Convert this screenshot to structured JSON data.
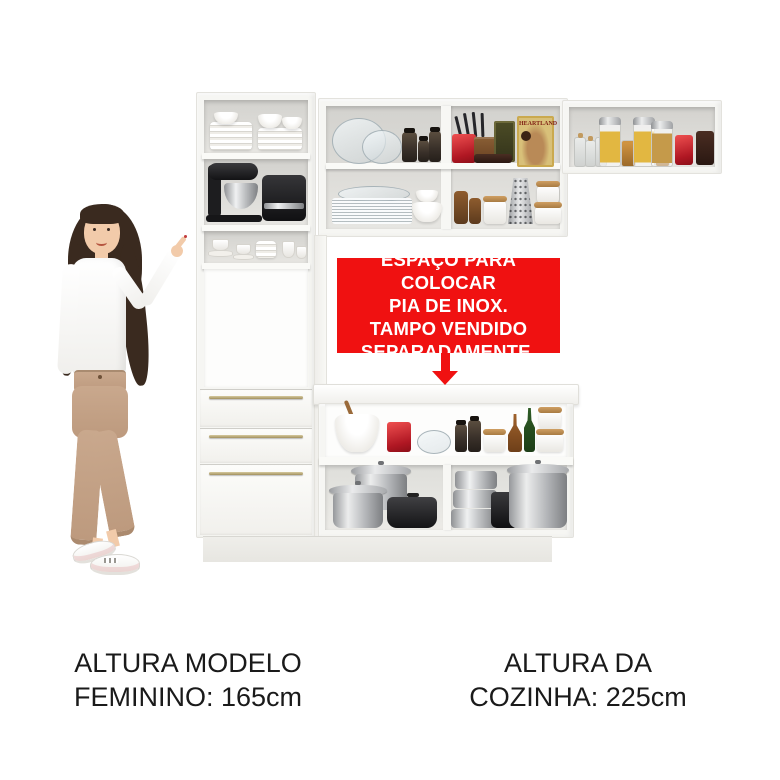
{
  "meta": {
    "image_type": "kitchen cabinet product photo with female model"
  },
  "banner": {
    "lines": [
      "ESPAÇO PARA COLOCAR",
      "PIA DE INOX.",
      "TAMPO VENDIDO",
      "SEPARADAMENTE."
    ],
    "bg_color": "#f01111",
    "text_color": "#ffffff",
    "arrow_icon": "arrow-down-icon"
  },
  "captions": {
    "model_height_line1": "ALTURA MODELO",
    "model_height_line2": "FEMININO: 165cm",
    "kitchen_height_line1": "ALTURA DA",
    "kitchen_height_line2": "COZINHA: 225cm",
    "text_color": "#1a1a1a"
  },
  "packages": {
    "heartland": "HEARTLAND"
  },
  "colors": {
    "banner_red": "#f01111",
    "cabinet_white": "#f6f6f3",
    "interior_gray": "#d7d6d2",
    "handle_gold": "#b3a674",
    "text_black": "#1a1a1a"
  },
  "scene_objects": {
    "left_figure": "woman model pointing at kitchen",
    "tall_cabinet": [
      "white plates and bowls",
      "black stand mixer with steel bowl",
      "black coffee machine",
      "white cups and saucers",
      "open microwave nook",
      "three drawers with gold handles"
    ],
    "upper_middle_cabinet": [
      "glass bowls",
      "dark spice jars",
      "red knife block with knives",
      "wooden box",
      "HEARTLAND food package",
      "stacked glass plates",
      "white bowls",
      "amber jars",
      "steel grater",
      "white canisters with wood lids"
    ],
    "upper_right_cabinet": [
      "corked glass bottles",
      "pasta jars with steel lids",
      "spice jars",
      "red canister",
      "brown canister"
    ],
    "counter": [
      "white bowl with wooden spoon",
      "red canister",
      "glass bowl",
      "black jars",
      "white canister with wood lid",
      "amber carafe",
      "green bottle",
      "stacked white canisters",
      "stainless pots with lids",
      "black dutch oven",
      "steamer stack",
      "black pitcher",
      "large stock pot"
    ]
  }
}
